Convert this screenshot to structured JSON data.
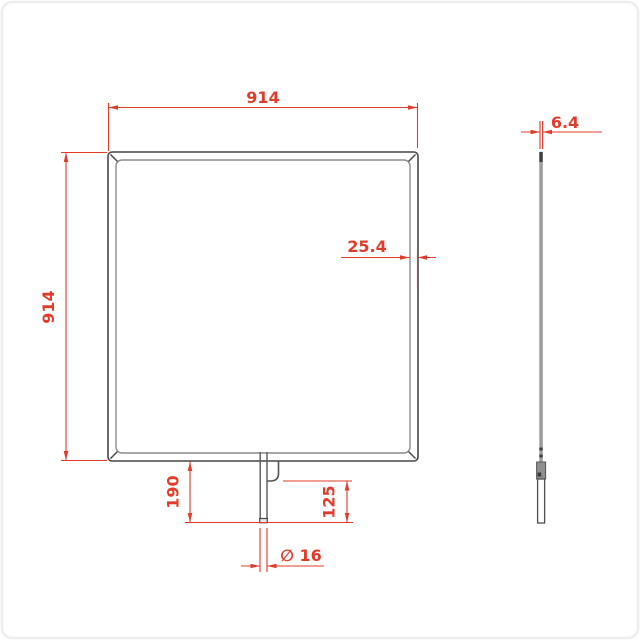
{
  "drawing": {
    "dimensions": {
      "front_width": "914",
      "front_height": "914",
      "frame_depth": "25.4",
      "pin_drop": "190",
      "pin_exposed": "125",
      "pin_diameter": "∅ 16",
      "panel_thickness": "6.4"
    },
    "colors": {
      "dimension_red": "#e23b2a",
      "line_dark": "#474747",
      "line_light": "#8c8c8c",
      "background": "#ffffff",
      "page_border": "#ededed"
    }
  }
}
